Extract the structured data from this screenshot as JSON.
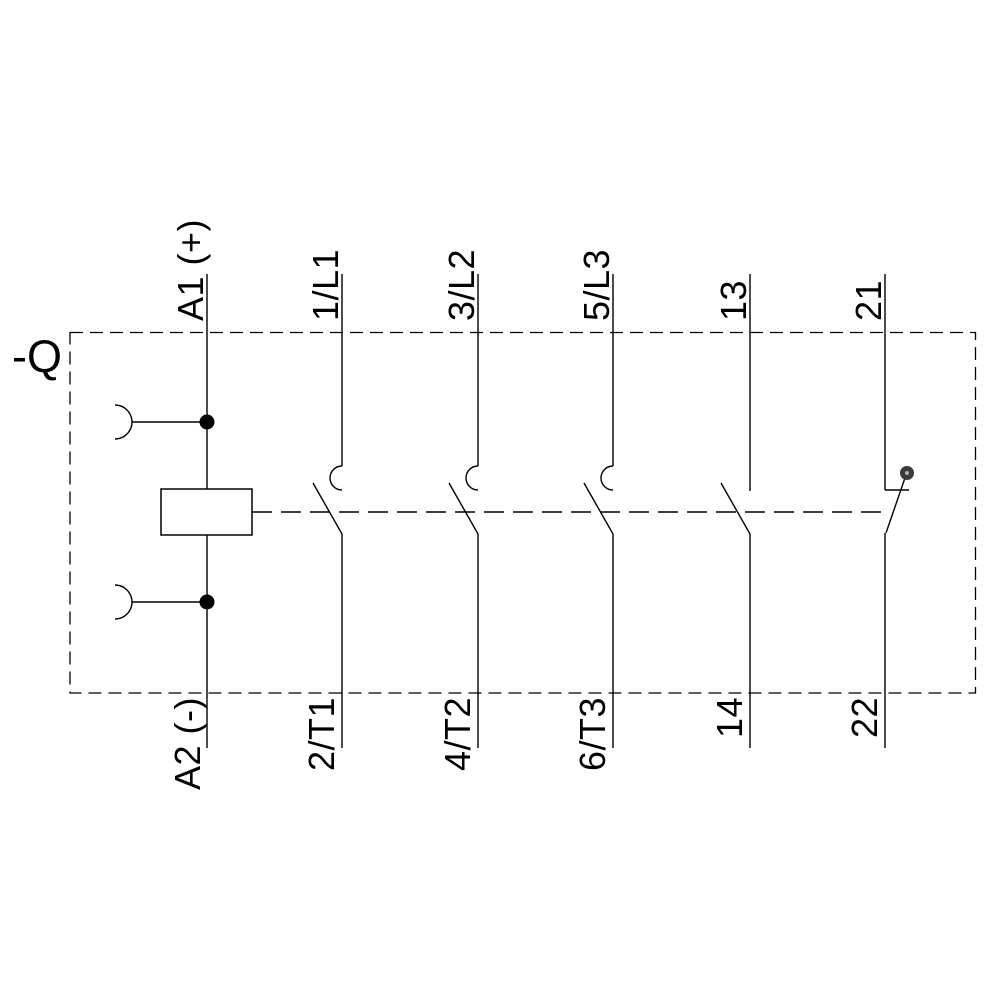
{
  "colors": {
    "background": "#ffffff",
    "line": "#000000",
    "nc_pivot": "#3a3a3a",
    "nc_pivot_center": "#b0b0b0"
  },
  "device_label": "-Q",
  "coil": {
    "symbol": "contactor-coil",
    "top_terminal": "A1 (+)",
    "bottom_terminal": "A2 (-)"
  },
  "main_contacts": [
    {
      "symbol": "no-main-contact",
      "top_terminal": "1/L1",
      "bottom_terminal": "2/T1"
    },
    {
      "symbol": "no-main-contact",
      "top_terminal": "3/L2",
      "bottom_terminal": "4/T2"
    },
    {
      "symbol": "no-main-contact",
      "top_terminal": "5/L3",
      "bottom_terminal": "6/T3"
    }
  ],
  "auxiliary_contacts": [
    {
      "symbol": "no-auxiliary-contact",
      "top_terminal": "13",
      "bottom_terminal": "14"
    },
    {
      "symbol": "nc-auxiliary-contact",
      "top_terminal": "21",
      "bottom_terminal": "22"
    }
  ]
}
